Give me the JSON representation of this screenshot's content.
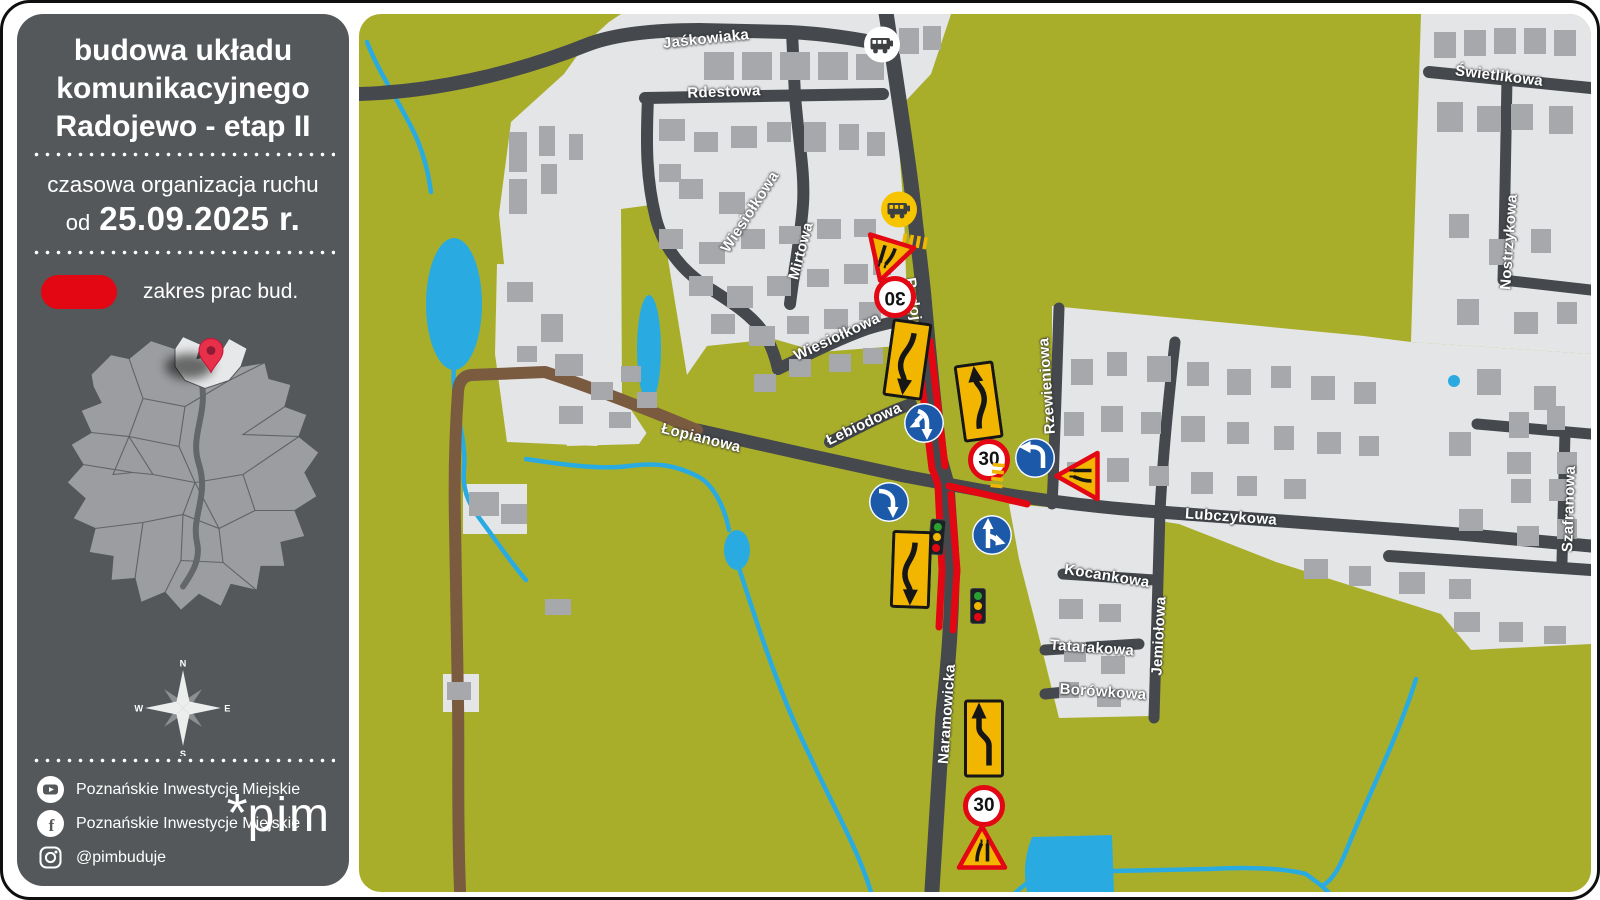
{
  "sidebar": {
    "title_lines": [
      "budowa układu",
      "komunikacyjnego",
      "Radojewo - etap II"
    ],
    "subtitle": "czasowa organizacja ruchu",
    "date_prefix": "od",
    "date": "25.09.2025 r.",
    "legend_label": "zakres prac bud.",
    "compass": {
      "n": "N",
      "e": "E",
      "s": "S",
      "w": "W"
    },
    "social": [
      {
        "icon": "youtube-icon",
        "label": "Poznańskie Inwestycje Miejskie"
      },
      {
        "icon": "facebook-icon",
        "label": "Poznańskie Inwestycje Miejskie"
      },
      {
        "icon": "instagram-icon",
        "label": "@pimbuduje"
      }
    ],
    "logo": {
      "asterisk": "*",
      "text": "pim"
    }
  },
  "map": {
    "colors": {
      "field_green": "#a9ae2a",
      "urban_gray": "#e4e5e7",
      "building_gray": "#a6a8ab",
      "road_dark": "#45494d",
      "dirt_brown": "#7a5b40",
      "water_blue": "#29abe2",
      "works_red": "#e30613",
      "sign_yellow": "#f2b600",
      "sign_blue": "#1c5aa9"
    },
    "streets": [
      {
        "name": "Jaśkowiaka",
        "x": 347,
        "y": 25,
        "rot": -6
      },
      {
        "name": "Rdestowa",
        "x": 365,
        "y": 78,
        "rot": -2
      },
      {
        "name": "Wiesiołkowa",
        "x": 391,
        "y": 198,
        "rot": -57
      },
      {
        "name": "Mirtowa",
        "x": 442,
        "y": 237,
        "rot": -75
      },
      {
        "name": "Wiesiołkowa",
        "x": 478,
        "y": 323,
        "rot": -25
      },
      {
        "name": "Radojewo",
        "x": 556,
        "y": 300,
        "rot": 82
      },
      {
        "name": "Łebiodowa",
        "x": 505,
        "y": 410,
        "rot": -25
      },
      {
        "name": "Łopianowa",
        "x": 342,
        "y": 424,
        "rot": 14
      },
      {
        "name": "Rzewieniowa",
        "x": 688,
        "y": 372,
        "rot": -94
      },
      {
        "name": "Lubczykowa",
        "x": 872,
        "y": 503,
        "rot": 4
      },
      {
        "name": "Kocankowa",
        "x": 748,
        "y": 562,
        "rot": 9
      },
      {
        "name": "Jemiołowa",
        "x": 800,
        "y": 622,
        "rot": -87
      },
      {
        "name": "Tatarakowa",
        "x": 733,
        "y": 634,
        "rot": 4
      },
      {
        "name": "Borówkowa",
        "x": 744,
        "y": 678,
        "rot": 4
      },
      {
        "name": "Naramowicka",
        "x": 588,
        "y": 700,
        "rot": -86
      },
      {
        "name": "Świetlikowa",
        "x": 1140,
        "y": 62,
        "rot": 7
      },
      {
        "name": "Nostrzykowa",
        "x": 1150,
        "y": 228,
        "rot": -86
      },
      {
        "name": "Szafranowa",
        "x": 1210,
        "y": 495,
        "rot": -88
      }
    ],
    "signs": [
      {
        "type": "bus",
        "variant": "white",
        "x": 523,
        "y": 33,
        "rot": 0
      },
      {
        "type": "bus",
        "variant": "yellow",
        "x": 540,
        "y": 198,
        "rot": 0
      },
      {
        "type": "crosswalk",
        "variant": "",
        "x": 556,
        "y": 230,
        "rot": 10
      },
      {
        "type": "triangle",
        "variant": "narrow",
        "x": 528,
        "y": 244,
        "rot": 197
      },
      {
        "type": "speed",
        "value": "30",
        "x": 536,
        "y": 283,
        "rot": 180
      },
      {
        "type": "plate",
        "variant": "s-down",
        "x": 548,
        "y": 348,
        "rot": 8
      },
      {
        "type": "plate",
        "variant": "s-up",
        "x": 620,
        "y": 390,
        "rot": -8
      },
      {
        "type": "blue",
        "variant": "fork-down-left",
        "x": 565,
        "y": 409,
        "rot": 0
      },
      {
        "type": "speed",
        "value": "30",
        "x": 630,
        "y": 446,
        "rot": 0
      },
      {
        "type": "blue",
        "variant": "turn-left",
        "x": 676,
        "y": 444,
        "rot": 0
      },
      {
        "type": "triangle",
        "variant": "narrow",
        "x": 721,
        "y": 462,
        "rot": -90
      },
      {
        "type": "crosswalk",
        "variant": "",
        "x": 636,
        "y": 462,
        "rot": 96
      },
      {
        "type": "blue",
        "variant": "bend-right",
        "x": 530,
        "y": 488,
        "rot": 0
      },
      {
        "type": "tlight",
        "variant": "",
        "x": 578,
        "y": 523,
        "rot": 5
      },
      {
        "type": "blue",
        "variant": "fork-up-right",
        "x": 633,
        "y": 521,
        "rot": 0
      },
      {
        "type": "plate",
        "variant": "s-down",
        "x": 552,
        "y": 558,
        "rot": 2
      },
      {
        "type": "tlight",
        "variant": "",
        "x": 619,
        "y": 592,
        "rot": 0
      },
      {
        "type": "plate",
        "variant": "shift-up",
        "x": 625,
        "y": 727,
        "rot": 0
      },
      {
        "type": "speed",
        "value": "30",
        "x": 625,
        "y": 792,
        "rot": 0
      },
      {
        "type": "triangle",
        "variant": "narrow",
        "x": 623,
        "y": 836,
        "rot": 0
      }
    ]
  }
}
